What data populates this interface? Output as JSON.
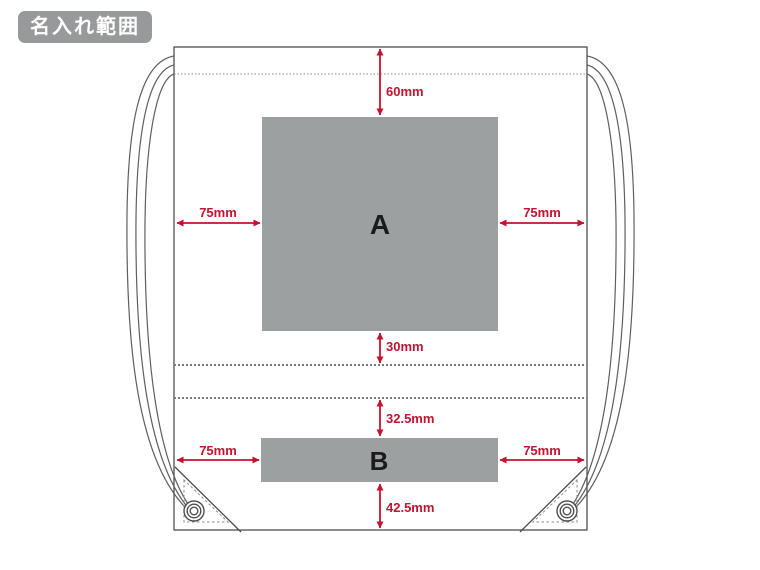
{
  "badge": {
    "label": "名入れ範囲"
  },
  "diagram": {
    "area_a": {
      "label": "A",
      "dim_top": "60mm",
      "dim_left": "75mm",
      "dim_right": "75mm",
      "dim_bottom": "30mm"
    },
    "area_b": {
      "label": "B",
      "dim_top": "32.5mm",
      "dim_left": "75mm",
      "dim_right": "75mm",
      "dim_bottom": "42.5mm"
    }
  },
  "colors": {
    "dimension_red": "#c4122f",
    "area_fill": "#9da0a0",
    "badge_bg": "#98999b",
    "outline": "#4d4d4d"
  }
}
